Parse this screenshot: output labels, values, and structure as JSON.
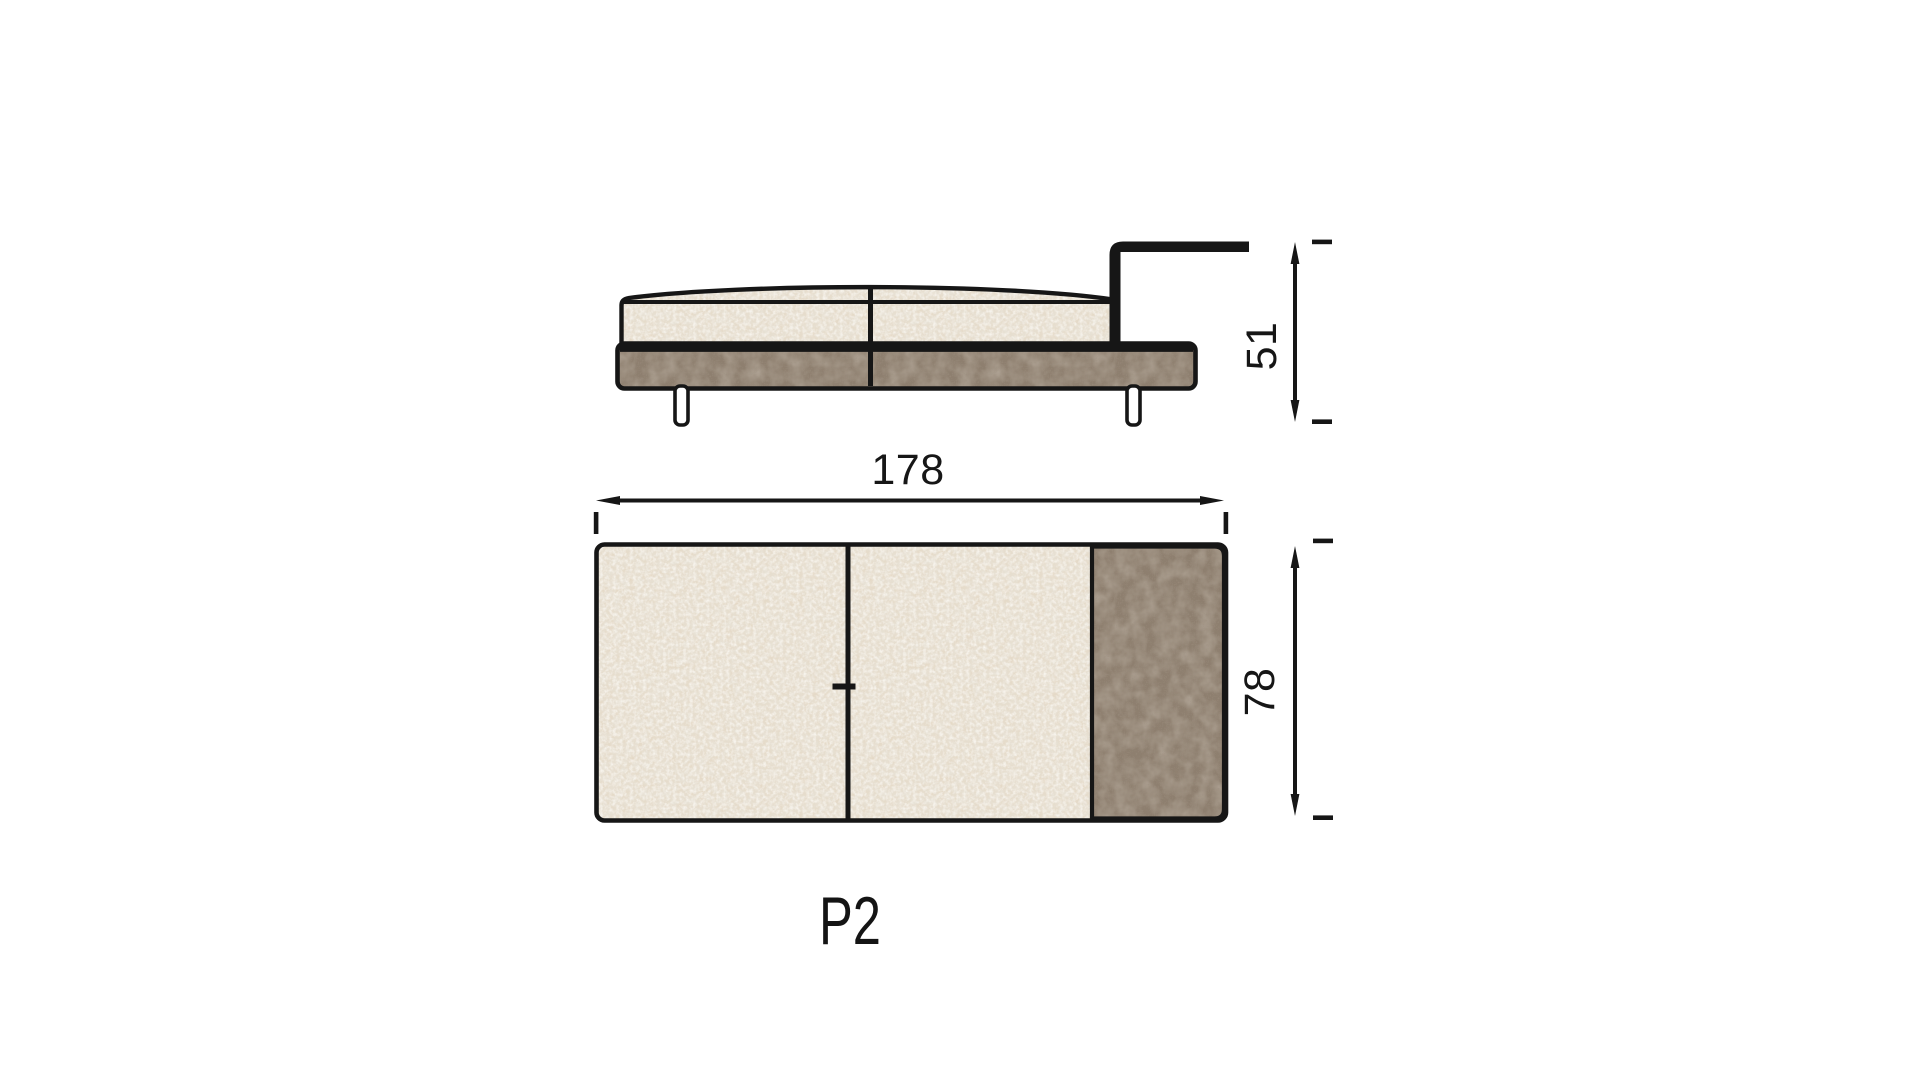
{
  "product": {
    "label": "P2"
  },
  "views": {
    "side": {
      "height_label": "51"
    },
    "top": {
      "width_label": "178",
      "depth_label": "78"
    }
  },
  "colors": {
    "outline": "#161616",
    "boucle_fabric": "#e8e2d6",
    "boucle_speckle": "#c6b79f",
    "leather": "#8e7f6f",
    "leather_grain": "#554a3c",
    "background": "#ffffff"
  }
}
